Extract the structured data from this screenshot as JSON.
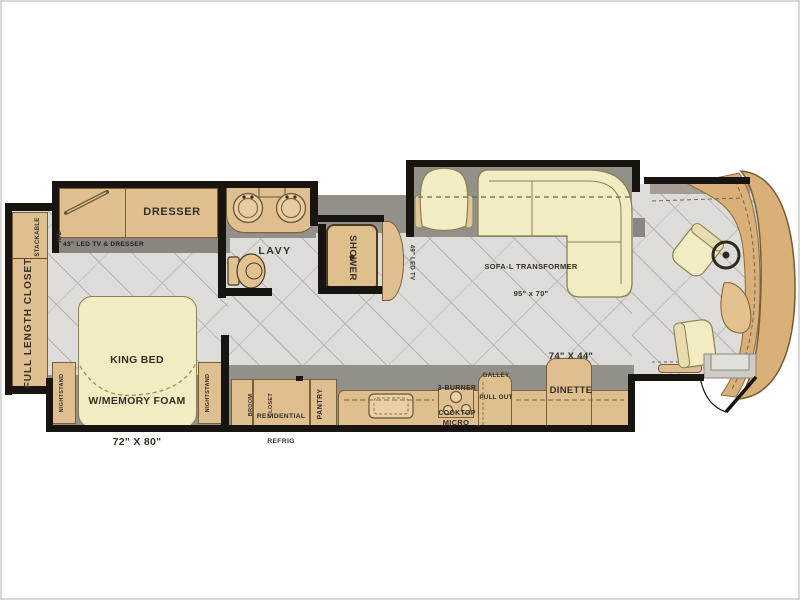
{
  "palette": {
    "wall": "#18140f",
    "floor_tile": "#dedcd8",
    "slide_floor": "#93908a",
    "cabinet_tan": "#dfbf90",
    "soft_furniture": "#f2ecc2",
    "front_cap": "#d8b078",
    "label_text": "#352f27"
  },
  "labels": {
    "bedroom": {
      "closet": "FULL LENGTH CLOSET",
      "washer_line1": "STACKABLE",
      "washer_line2": "W/D",
      "dresser": "DRESSER",
      "tv_dresser": "43\" LED TV & DRESSER",
      "bed_line1": "KING BED",
      "bed_line2": "W/MEMORY FOAM",
      "bed_line3": "72\" X 80\"",
      "nightstand_left": "NIGHTSTAND",
      "nightstand_right": "NIGHTSTAND"
    },
    "bath": {
      "lavy": "LAVY",
      "shower": "SHOWER"
    },
    "living": {
      "tv": "49\" LED TV",
      "sofa_line1": "SOFA-L TRANSFORMER",
      "sofa_line2": "95\" x 70\"",
      "dinette_line1": "74\" X 44\"",
      "dinette_line2": "DINETTE"
    },
    "kitchen": {
      "galley_line1": "GALLEY",
      "galley_line2": "PULL OUT",
      "cooktop_line1": "3-BURNER",
      "cooktop_line2": "COOKTOP",
      "micro": "MICRO",
      "refrig_line1": "RESIDENTIAL",
      "refrig_line2": "REFRIG",
      "broom_line1": "BROOM",
      "broom_line2": "CLOSET",
      "pantry": "PANTRY"
    }
  }
}
